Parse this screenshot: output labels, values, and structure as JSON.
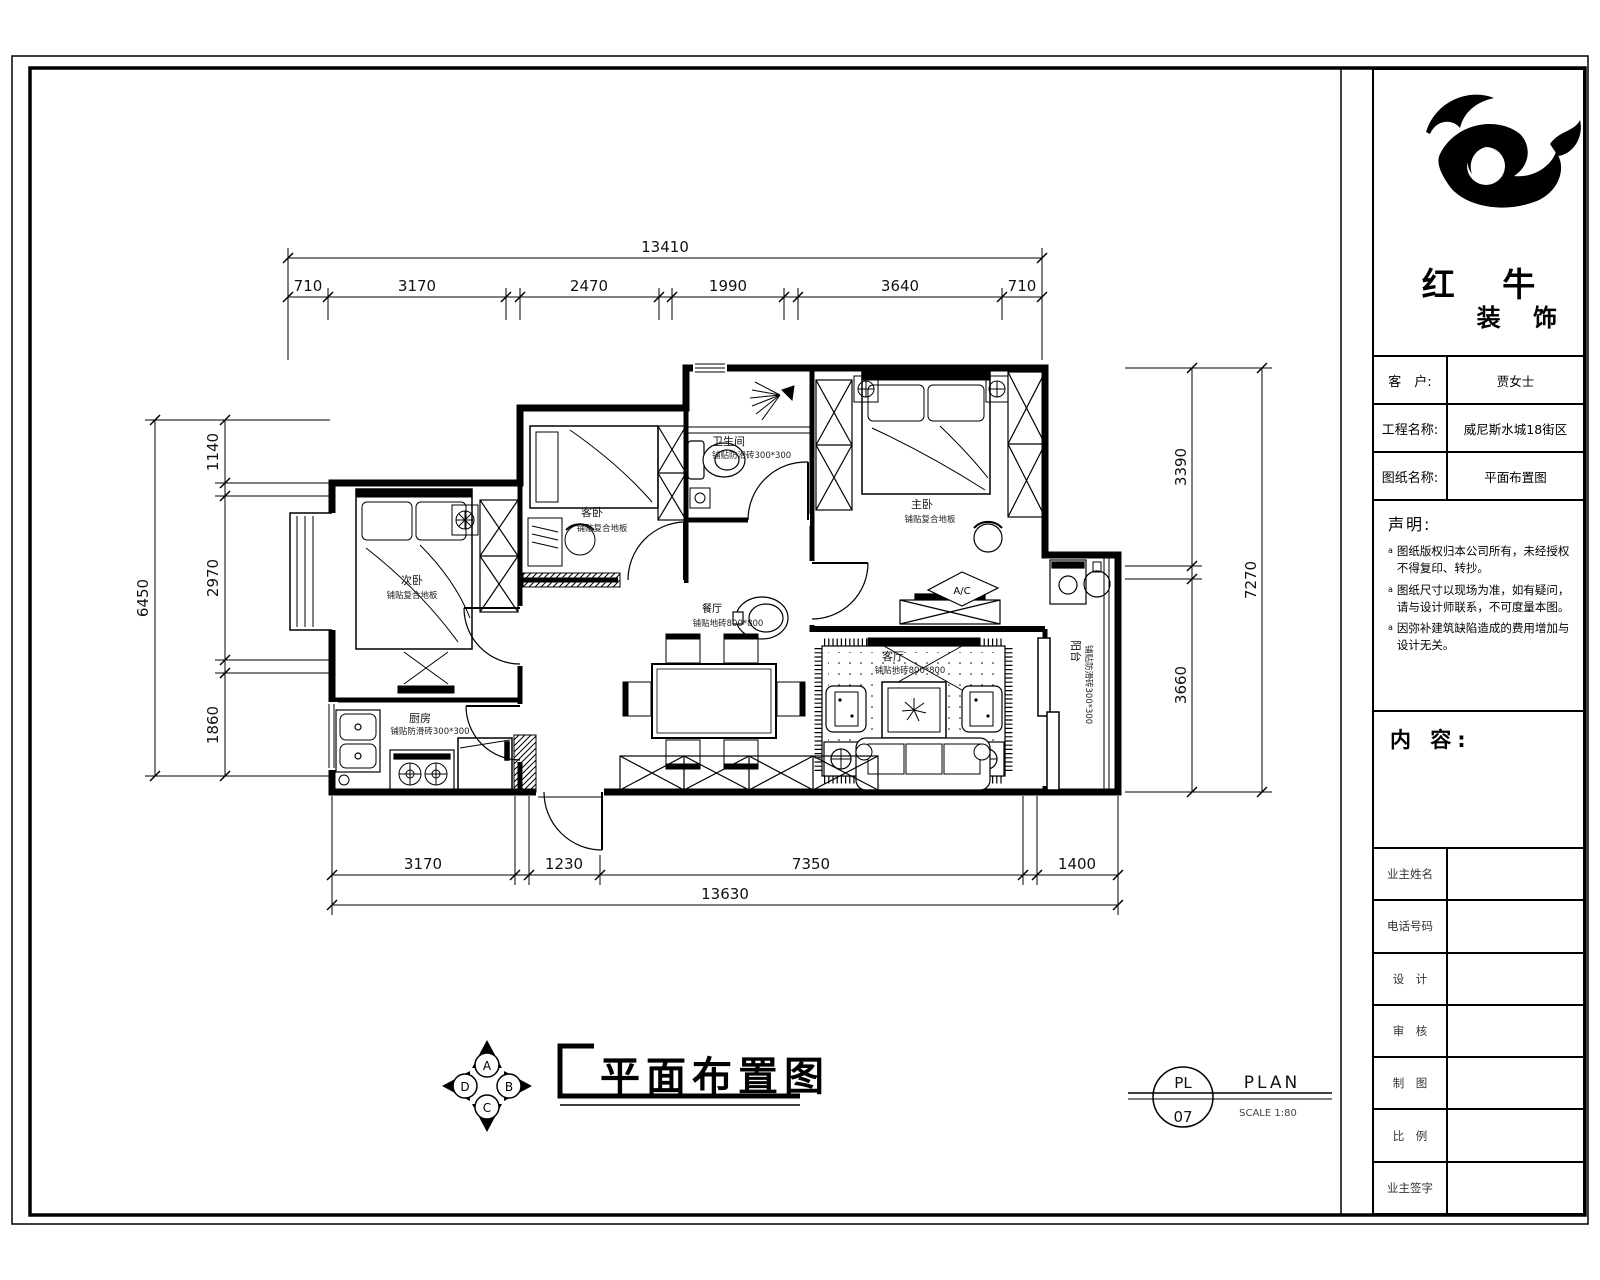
{
  "title_block": {
    "company_name_top": "红 牛",
    "company_name_bottom": "装 饰",
    "fields": [
      {
        "label": "客　户:",
        "value": "贾女士"
      },
      {
        "label": "工程名称:",
        "value": "威尼斯水城18街区"
      },
      {
        "label": "图纸名称:",
        "value": "平面布置图"
      }
    ],
    "statement_heading": "声明:",
    "statement_marker": "a",
    "statement_items": [
      "图纸版权归本公司所有，未经授权不得复印、转抄。",
      "图纸尺寸以现场为准，如有疑问，请与设计师联系，不可度量本图。",
      "因弥补建筑缺陷造成的费用增加与设计无关。"
    ],
    "content_heading": "内 容:",
    "info_rows": [
      "业主姓名",
      "电话号码",
      "设　计",
      "审　核",
      "制　图",
      "比　例",
      "业主签字"
    ]
  },
  "plan": {
    "rooms": {
      "secondary_bedroom": {
        "name": "次卧",
        "spec": "铺贴复合地板"
      },
      "guest_bedroom": {
        "name": "客卧",
        "spec": "铺贴复合地板"
      },
      "master_bedroom": {
        "name": "主卧",
        "spec": "铺贴复合地板"
      },
      "bathroom": {
        "name": "卫生间",
        "spec": "铺贴防滑砖300*300"
      },
      "kitchen": {
        "name": "厨房",
        "spec": "铺贴防滑砖300*300"
      },
      "dining": {
        "name": "餐厅",
        "spec": "铺贴地砖800*800"
      },
      "living": {
        "name": "客厅",
        "spec": "铺贴地砖800*800"
      },
      "balcony": {
        "name": "阳台",
        "spec": "铺贴防滑砖300*300"
      }
    },
    "ac_label": "A/C"
  },
  "dimensions": {
    "top": {
      "overall": "13410",
      "segments": [
        "710",
        "3170",
        "2470",
        "1990",
        "3640",
        "710"
      ]
    },
    "left": {
      "overall": "6450",
      "segments": [
        "1140",
        "2970",
        "1860"
      ]
    },
    "right": {
      "overall": "7270",
      "segments": [
        "3390",
        "3660"
      ]
    },
    "bottom": {
      "overall": "13630",
      "segments": [
        "3170",
        "1230",
        "7350",
        "1400"
      ]
    }
  },
  "footer": {
    "drawing_title": "平面布置图",
    "compass": {
      "top": "A",
      "right": "B",
      "bottom": "C",
      "left": "D"
    },
    "stamp": {
      "code": "PL",
      "number": "07",
      "name": "PLAN",
      "scale": "SCALE 1:80"
    }
  }
}
